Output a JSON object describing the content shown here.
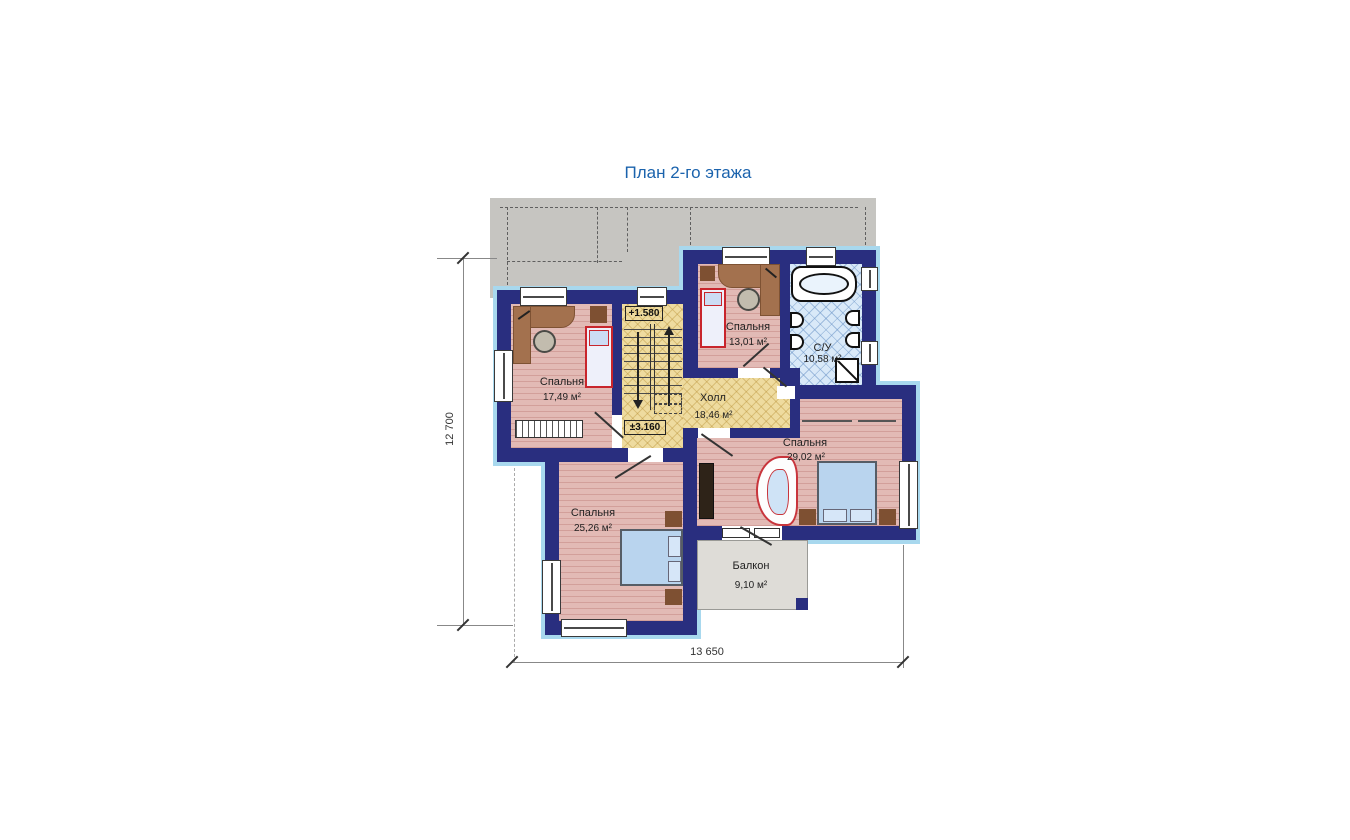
{
  "title": "План 2-го этажа",
  "rooms": {
    "bedroom_tl": {
      "name": "Спальня",
      "area": "17,49 м²"
    },
    "bedroom_tm": {
      "name": "Спальня",
      "area": "13,01 м²"
    },
    "bathroom": {
      "name": "С/У",
      "area": "10,58 м²"
    },
    "hall": {
      "name": "Холл",
      "area": "18,46 м²"
    },
    "bedroom_r": {
      "name": "Спальня",
      "area": "29,02 м²"
    },
    "bedroom_bl": {
      "name": "Спальня",
      "area": "25,26 м²"
    },
    "balcony": {
      "name": "Балкон",
      "area": "9,10 м²"
    }
  },
  "elevations": {
    "landing": "+1.580",
    "floor": "±3.160"
  },
  "dimensions": {
    "horizontal": "13 650",
    "vertical": "12 700"
  },
  "colors": {
    "wall": "#292e7f",
    "room_floor": "#e2bab5",
    "hall_floor": "#eedb9f",
    "bath_floor": "#d9e9f8",
    "roof": "#c6c5c1",
    "trim": "#a8d8ee",
    "title_text": "#1b63ad"
  }
}
